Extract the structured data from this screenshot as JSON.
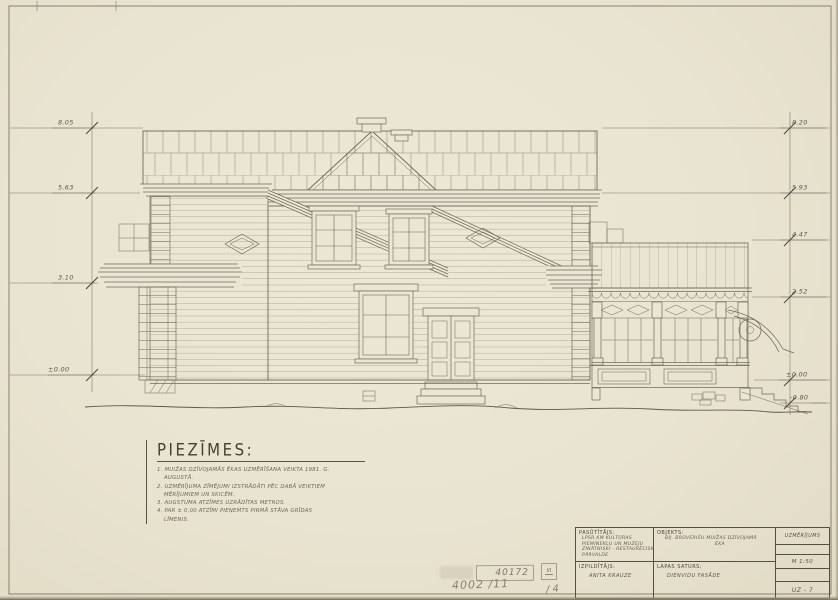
{
  "palette": {
    "paper": "#ebe6d4",
    "ink": "#6f6959",
    "ink_dark": "#55503f",
    "pencil": "#8a8270"
  },
  "notes": {
    "heading": "PIEZĪMES:",
    "lines": [
      "1. MUIŽAS DZĪVOJAMĀS ĒKAS UZMĒRĪŠANA VEIKTA 1981. G.",
      "AUGUSTĀ.",
      "2. UZMĒRĪJUMA ZĪMĒJUMI IZSTRĀDĀTI PĒC DABĀ VEIKTIEM",
      "MĒRĪJUMIEM UN SKICĒM.",
      "3. AUGSTUMA ATZĪMES UZRĀDĪTAS METROS.",
      "4. PAR ± 0.00 ATZĪMI PIEŅEMTS PIRMĀ STĀVA GRĪDAS",
      "LĪMENIS."
    ]
  },
  "dimensions": {
    "left": [
      {
        "label": "8.05"
      },
      {
        "label": "5.63"
      },
      {
        "label": "3.10"
      },
      {
        "label": "±0.00"
      }
    ],
    "right": [
      {
        "label": "8.20"
      },
      {
        "label": "5.93"
      },
      {
        "label": "4.47"
      },
      {
        "label": "2.52"
      },
      {
        "label": "±0.00"
      },
      {
        "label": "-0.80"
      }
    ]
  },
  "title_block": {
    "client_label": "PASŪTĪTĀJS:",
    "client_lines": [
      "LPSR KM KULTŪRAS",
      "PIEMINEKĻU UN MUZEJU",
      "ZINĀTNISKI - RESTAURĒCISKĀ",
      "PĀRVALDE"
    ],
    "executor_label": "IZPILDĪTĀJS:",
    "executor_name": "ANITA KRAUZE",
    "object_label": "OBJEKTS:",
    "object_lines": [
      "BIJ. BRŪVERIŠU MUIŽAS   DZĪVOJAMĀ",
      "ĒKA"
    ],
    "content_label": "LAPAS SATURS:",
    "content_value": "DIENVIDU FASĀDE",
    "type_value": "UZMĒRĪJUMS",
    "scale_value": "M 1:50",
    "sheet_code": "UZ - 7"
  },
  "stamp": {
    "number": "40172",
    "roman": "III",
    "doc_no": "4002 /11",
    "sheet_no": "/ 4"
  }
}
